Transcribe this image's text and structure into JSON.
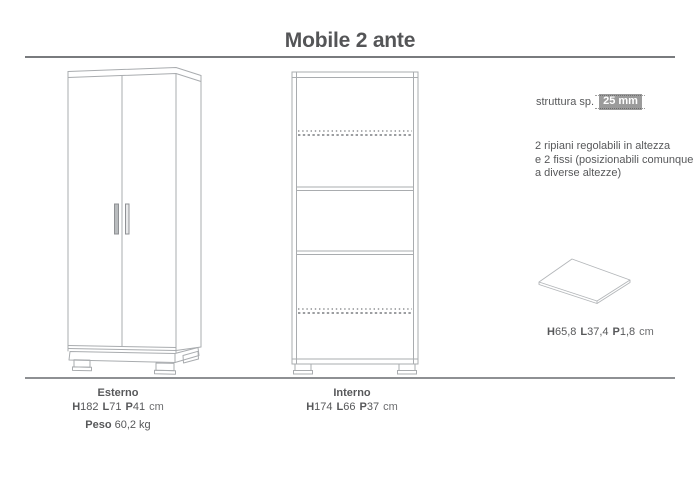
{
  "title": "Mobile 2 ante",
  "specs": {
    "structure_label": "struttura sp.",
    "structure_thickness": "25 mm",
    "shelves_note_line1": "2 ripiani regolabili in altezza",
    "shelves_note_line2": "e 2 fissi (posizionabili comunque",
    "shelves_note_line3": "a diverse altezze)",
    "shelf_dims": {
      "d1b": "H",
      "d1": "65,8",
      "d2b": "L",
      "d2": "37,4",
      "d3b": "P",
      "d3": "1,8",
      "unit": "cm"
    }
  },
  "bottom": {
    "esterno": {
      "label": "Esterno",
      "dims": {
        "d1b": "H",
        "d1": "182",
        "d2b": "L",
        "d2": "71",
        "d3b": "P",
        "d3": "41",
        "unit": "cm"
      },
      "peso_label": "Peso",
      "peso_value": "60,2 kg"
    },
    "interno": {
      "label": "Interno",
      "dims": {
        "d1b": "H",
        "d1": "174",
        "d2b": "L",
        "d2": "66",
        "d3b": "P",
        "d3": "37",
        "unit": "cm"
      }
    }
  },
  "drawings": {
    "exterior_icon": "wardrobe-two-doors-front-icon",
    "interior_icon": "open-carcass-shelves-icon",
    "shelf_icon": "shelf-panel-icon"
  },
  "colors": {
    "text": "#57585a",
    "drawing_line": "#a9acaf",
    "dashed_shelf_line": "#909295",
    "badge_bg": "#9b9b9b",
    "badge_text": "#ffffff",
    "rule_top": "#797b7e",
    "rule_bottom": "#8e9093"
  }
}
